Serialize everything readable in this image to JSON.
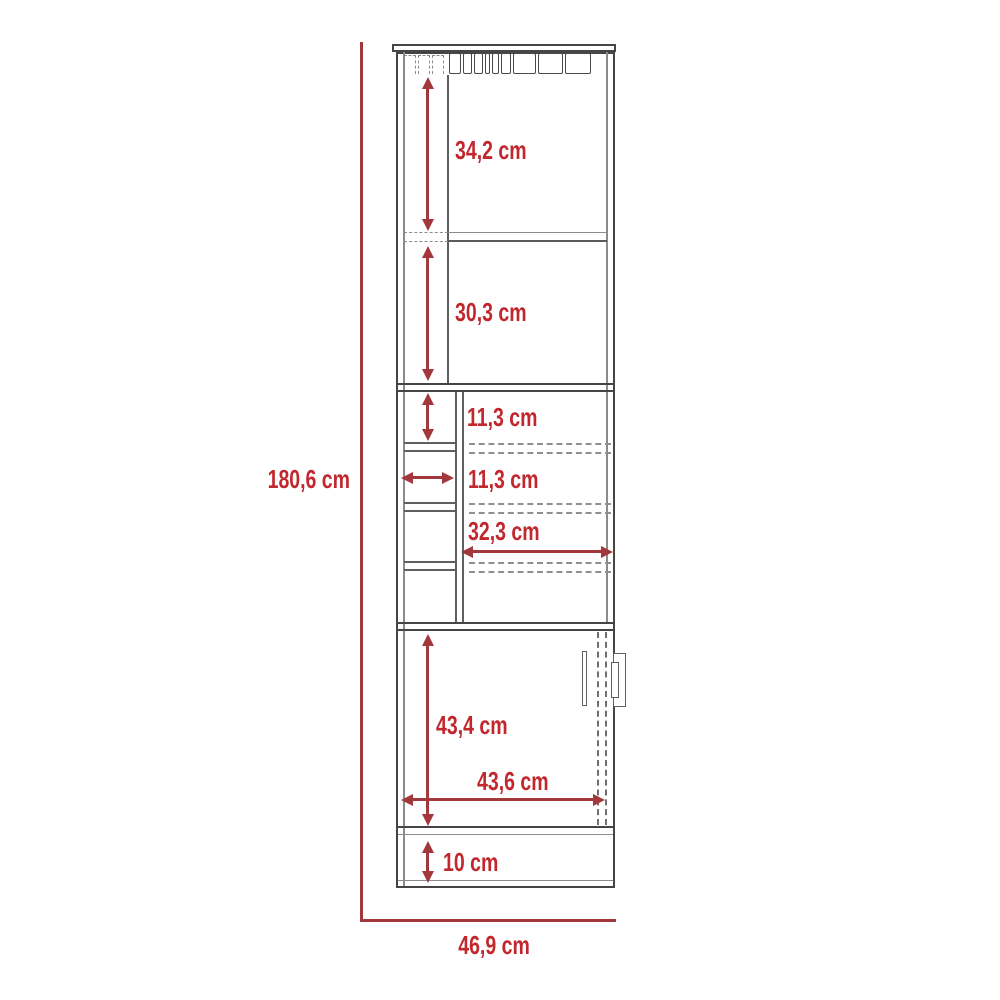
{
  "diagram": {
    "type": "furniture-dimension-drawing",
    "subject": "tall bar cabinet with stemware rack, shelves, cubbies and lower door",
    "unit": "cm",
    "dims": {
      "total_height": "180,6 cm",
      "total_width": "46,9 cm",
      "top_section_height": "34,2 cm",
      "second_section_height": "30,3 cm",
      "cubby_height": "11,3 cm",
      "cubby_width": "11,3 cm",
      "interior_shelf_width": "32,3 cm",
      "door_height": "43,4 cm",
      "door_width": "43,6 cm",
      "base_height": "10 cm"
    },
    "colors": {
      "dimension_line": "#A2383C",
      "dimension_text": "#C1272D",
      "cabinet_outline": "#454545",
      "inner_lines": "#8c8c8c",
      "background": "#ffffff"
    }
  }
}
